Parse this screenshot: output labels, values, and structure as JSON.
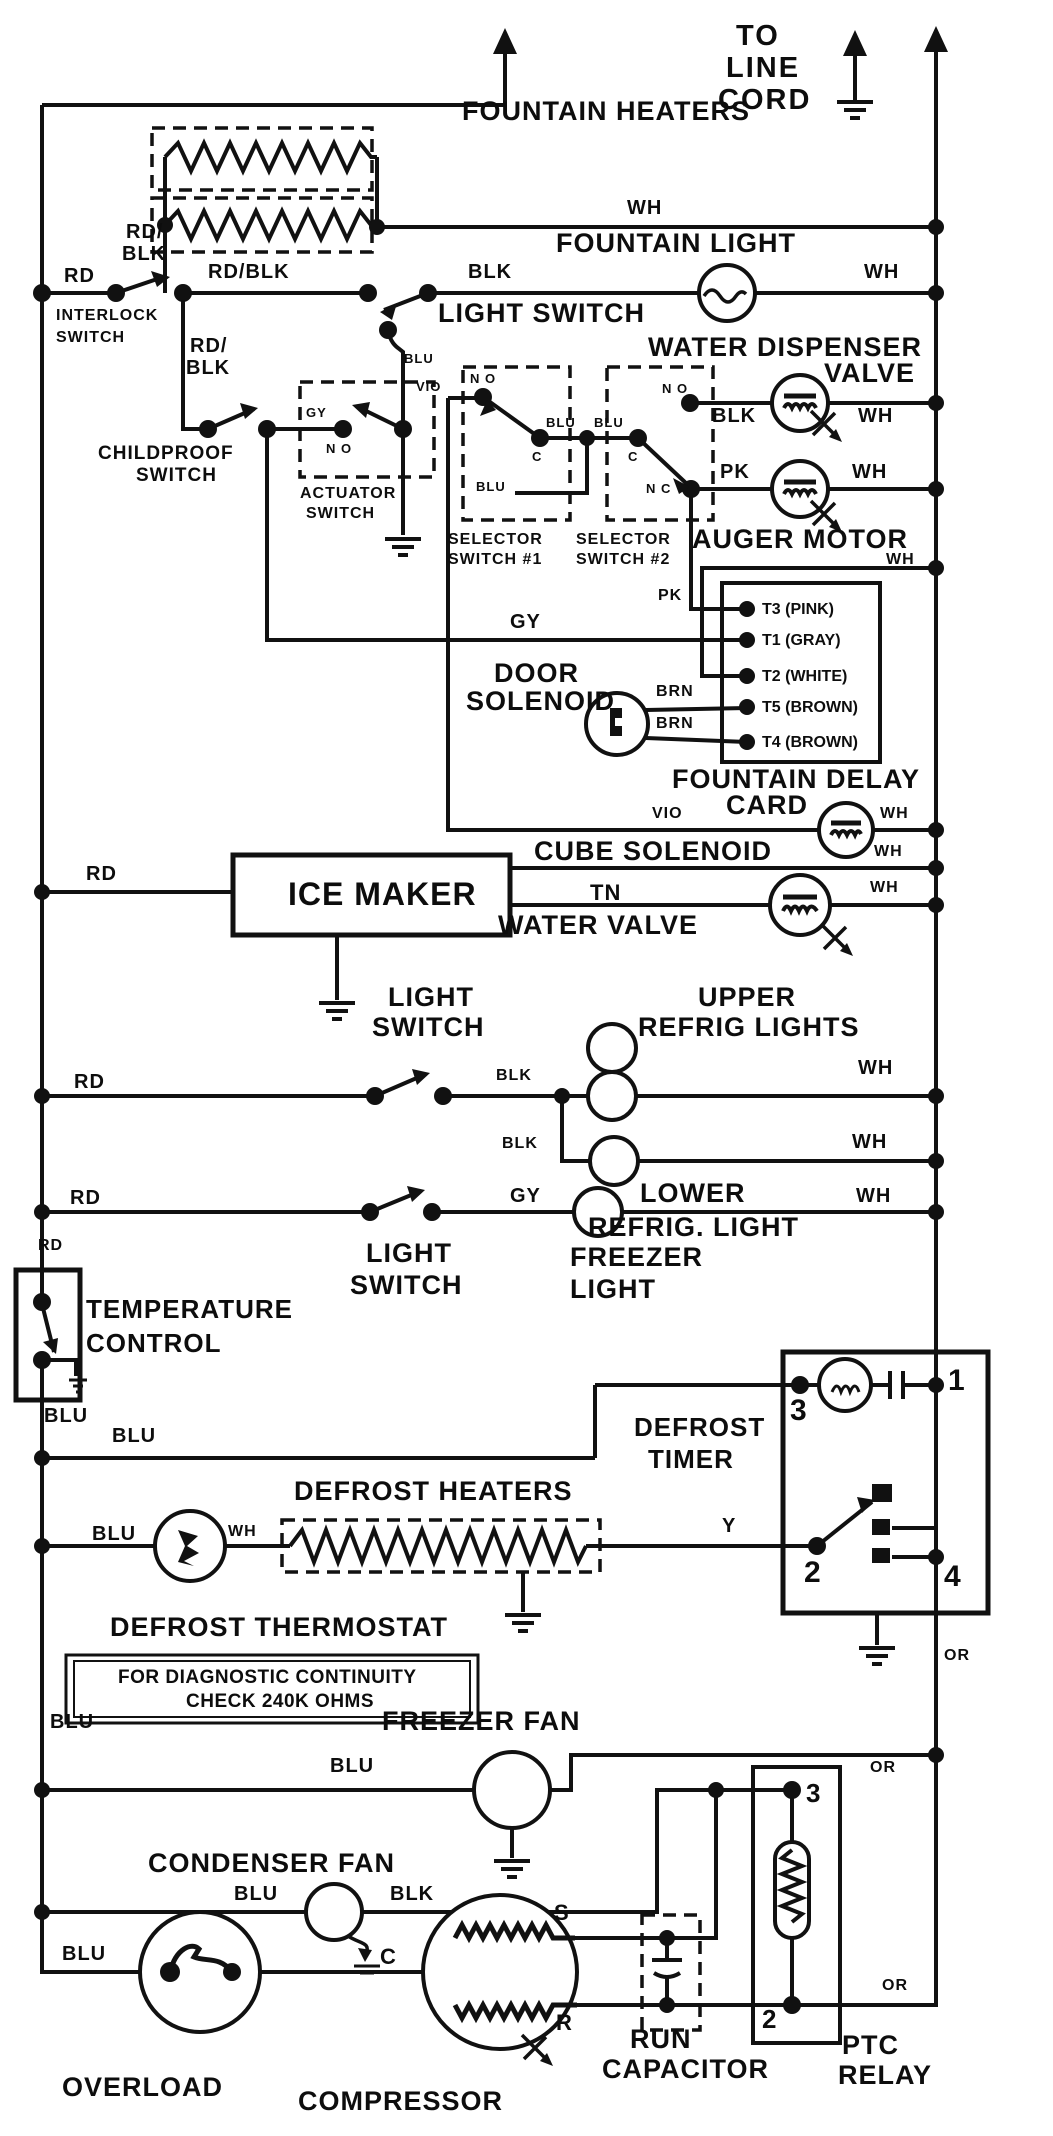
{
  "doc": {
    "kind": "refrigerator wiring diagram"
  },
  "colors": {
    "ink": "#111111",
    "paper": "#ffffff"
  },
  "header": {
    "to": "TO",
    "line": "LINE",
    "cord": "CORD"
  },
  "wires": {
    "wh": "WH",
    "blk": "BLK",
    "rd": "RD",
    "blu": "BLU",
    "gy": "GY",
    "vio": "VIO",
    "pk": "PK",
    "tn": "TN",
    "y": "Y",
    "or": "OR",
    "brn": "BRN",
    "rd_blk": "RD/BLK",
    "rd_slash": "RD/"
  },
  "contacts": {
    "no": "N O",
    "nc": "N C",
    "c": "C"
  },
  "components": {
    "fountain_heaters": "FOUNTAIN HEATERS",
    "fountain_light": "FOUNTAIN LIGHT",
    "light_switch": "LIGHT SWITCH",
    "interlock": "INTERLOCK",
    "switch": "SWITCH",
    "light": "LIGHT",
    "childproof": "CHILDPROOF",
    "actuator": "ACTUATOR",
    "water_dispenser": "WATER DISPENSER",
    "valve": "VALVE",
    "auger_motor": "AUGER MOTOR",
    "selector": "SELECTOR",
    "switch_no1": "SWITCH #1",
    "switch_no2": "SWITCH #2",
    "door": "DOOR",
    "solenoid": "SOLENOID",
    "fountain_delay": "FOUNTAIN DELAY",
    "card": "CARD",
    "cube_solenoid": "CUBE SOLENOID",
    "ice_maker": "ICE MAKER",
    "water_valve": "WATER VALVE",
    "upper": "UPPER",
    "refrig_lights": "REFRIG LIGHTS",
    "lower": "LOWER",
    "refrig_light": "REFRIG. LIGHT",
    "freezer": "FREEZER",
    "temperature": "TEMPERATURE",
    "control": "CONTROL",
    "defrost": "DEFROST",
    "timer": "TIMER",
    "defrost_heaters": "DEFROST HEATERS",
    "defrost_thermostat": "DEFROST THERMOSTAT",
    "freezer_fan": "FREEZER FAN",
    "condenser_fan": "CONDENSER FAN",
    "overload": "OVERLOAD",
    "compressor": "COMPRESSOR",
    "run": "RUN",
    "capacitor": "CAPACITOR",
    "ptc": "PTC",
    "relay": "RELAY"
  },
  "terminals": {
    "t3": "T3 (PINK)",
    "t1": "T1 (GRAY)",
    "t2": "T2 (WHITE)",
    "t5": "T5 (BROWN)",
    "t4": "T4 (BROWN)",
    "n1": "1",
    "n2": "2",
    "n3": "3",
    "n4": "4",
    "s": "S",
    "r": "R",
    "c": "C"
  },
  "notes": {
    "diag1": "FOR DIAGNOSTIC CONTINUITY",
    "diag2": "CHECK 240K OHMS"
  }
}
